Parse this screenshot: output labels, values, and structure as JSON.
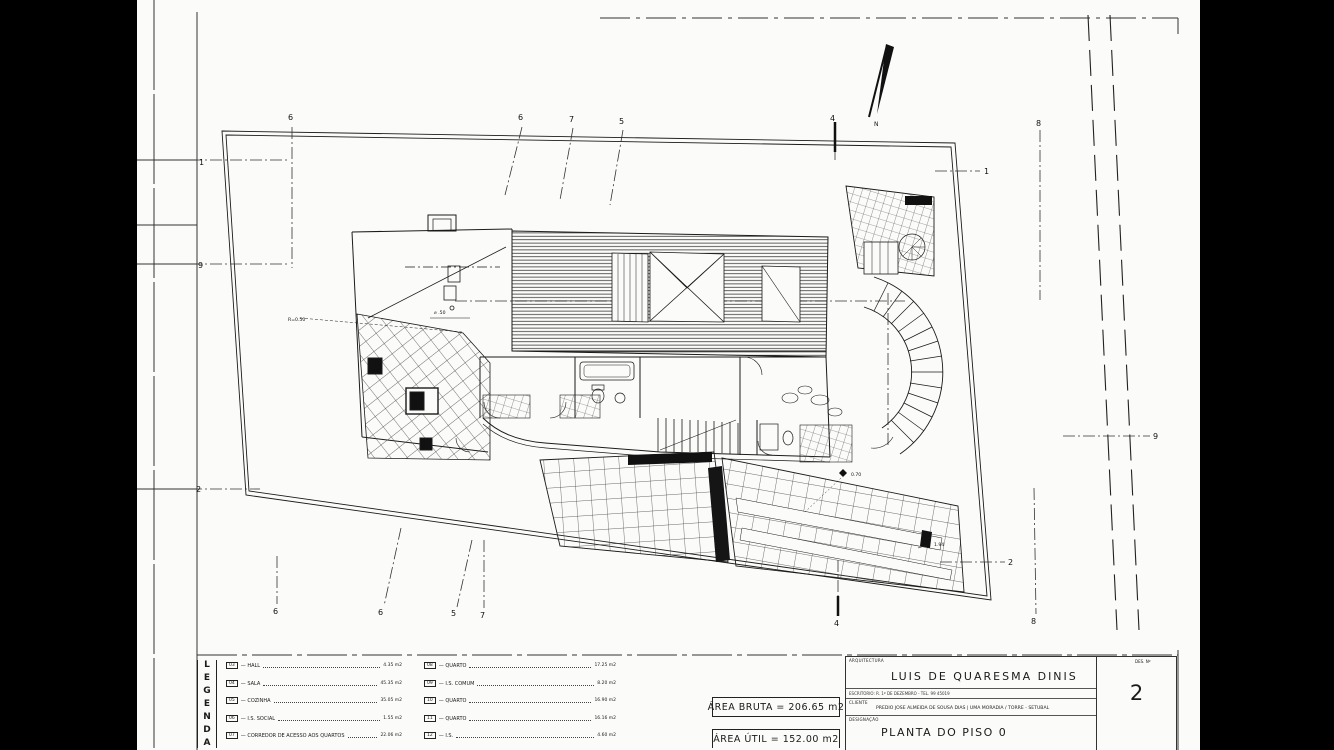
{
  "plan": {
    "north_label": "N",
    "grid_top": [
      "6",
      "6",
      "7",
      "5",
      "4",
      "8"
    ],
    "grid_bottom": [
      "6",
      "6",
      "5",
      "7",
      "4",
      "8"
    ],
    "grid_left": [
      "1",
      "9",
      "2"
    ],
    "grid_right": [
      "1",
      "2",
      "9"
    ],
    "annotations": {
      "r050": "R=0.50",
      "d050": "⌀ .50",
      "d070": "0.70",
      "d194": "1.94"
    }
  },
  "legend": {
    "letters": [
      "L",
      "E",
      "G",
      "E",
      "N",
      "D",
      "A"
    ],
    "items_left": [
      {
        "num": "03",
        "label": "HALL",
        "value": "4.35 m2"
      },
      {
        "num": "04",
        "label": "SALA",
        "value": "45.35 m2"
      },
      {
        "num": "05",
        "label": "COZINHA",
        "value": "35.05 m2"
      },
      {
        "num": "06",
        "label": "I.S. SOCIAL",
        "value": "1.55 m2"
      },
      {
        "num": "07",
        "label": "CORREDOR DE ACESSO AOS QUARTOS",
        "value": "22.06 m2"
      }
    ],
    "items_right": [
      {
        "num": "08",
        "label": "QUARTO",
        "value": "17.25 m2"
      },
      {
        "num": "09",
        "label": "I.S. COMUM",
        "value": "8.20 m2"
      },
      {
        "num": "10",
        "label": "QUARTO",
        "value": "16.90 m2"
      },
      {
        "num": "11",
        "label": "QUARTO",
        "value": "16.16 m2"
      },
      {
        "num": "12",
        "label": "I.S.",
        "value": "4.60 m2"
      }
    ]
  },
  "areas": {
    "bruta": "ÁREA BRUTA = 206.65 m2",
    "util": "ÁREA ÚTIL = 152.00 m2"
  },
  "titleblock": {
    "section_label": "ARQUITECTURA",
    "architect": "LUIS DE QUARESMA DINIS",
    "office_line": "ESCRITORIO: R. 1º DE DEZEMBRO - TEL. 99 45019",
    "client_label": "CLIENTE",
    "client_line": "PREDIO JOSE ALMEIDA DE SOUSA DIAS | UMA MORADIA / TORRE - SETUBAL",
    "designation_label": "DESIGNAÇÃO",
    "designation": "PLANTA DO PISO 0",
    "sheet_label": "DES. Nº",
    "sheet_number": "2"
  }
}
